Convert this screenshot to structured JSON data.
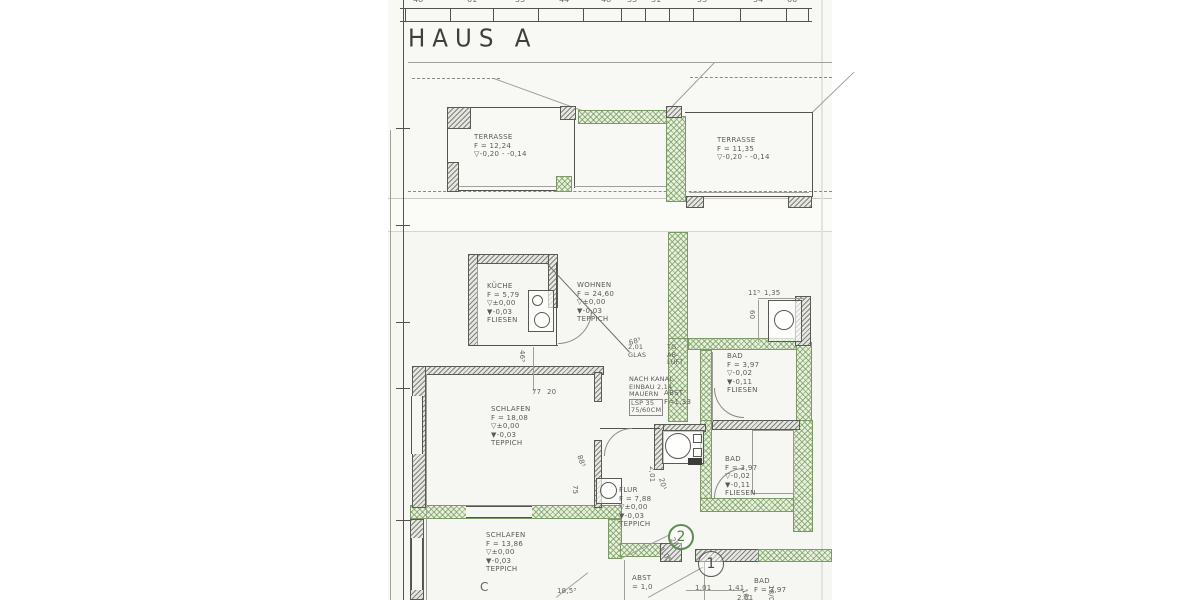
{
  "title": "HAUS A",
  "colors": {
    "paper": "#f6f6f2",
    "ink": "#55524d",
    "green_wall": "#689252",
    "marker_green": "#5d8f52"
  },
  "rooms": [
    {
      "name": "TERRASSE",
      "area": "F = 12,24",
      "level1": "▽-0,20 - -0,14"
    },
    {
      "name": "TERRASSE",
      "area": "F = 11,35",
      "level1": "▽-0,20 - -0,14"
    },
    {
      "name": "KÜCHE",
      "area": "F = 5,79",
      "level1": "▽±0,00",
      "level2": "▼-0,03",
      "floor": "FLIESEN"
    },
    {
      "name": "WOHNEN",
      "area": "F = 24,60",
      "level1": "▽±0,00",
      "level2": "▼-0,03",
      "floor": "TEPPICH"
    },
    {
      "name": "BAD",
      "area": "F = 3,97",
      "level1": "▽-0,02",
      "level2": "▼-0,11",
      "floor": "FLIESEN"
    },
    {
      "name": "SCHLAFEN",
      "area": "F = 18,08",
      "level1": "▽±0,00",
      "level2": "▼-0,03",
      "floor": "TEPPICH"
    },
    {
      "name": "ABST",
      "area": "F=1,33"
    },
    {
      "name": "BAD",
      "area": "F = 3,97",
      "level1": "▽-0,02",
      "level2": "▼-0,11",
      "floor": "FLIESEN"
    },
    {
      "name": "FLUR",
      "area": "F = 7,88",
      "level1": "▽±0,00",
      "level2": "▼-0,03",
      "floor": "TEPPICH"
    },
    {
      "name": "SCHLAFEN",
      "area": "F = 13,86",
      "level1": "▽±0,00",
      "level2": "▼-0,03",
      "floor": "TEPPICH"
    },
    {
      "name": "ABST",
      "area": "= 1,0"
    },
    {
      "name": "BAD",
      "area": "F = 3,97"
    }
  ],
  "notes": {
    "kanal": {
      "l1": "NACH KANAL",
      "l2": "EINBAU 2,14",
      "l3": "MAUERN",
      "l4": "LSP 35",
      "l5": "75/60CM"
    },
    "glas": {
      "l1": "2,01",
      "l2": "GLAS"
    },
    "abluft": {
      "l1": "TG",
      "l2": "AB-",
      "l3": "LUFT"
    }
  },
  "markers": {
    "m1": "1",
    "m2": "2"
  },
  "dimensions": [
    {
      "t": "11⁵",
      "x": 748,
      "y": 289
    },
    {
      "t": "1,35",
      "x": 764,
      "y": 289
    },
    {
      "t": "60",
      "x": 756,
      "y": 310,
      "r": 90
    },
    {
      "t": "46⁵",
      "x": 526,
      "y": 350,
      "r": 90
    },
    {
      "t": "77",
      "x": 532,
      "y": 388
    },
    {
      "t": "20",
      "x": 547,
      "y": 388
    },
    {
      "t": "68⁵",
      "x": 628,
      "y": 339,
      "r": -14
    },
    {
      "t": "88⁵",
      "x": 583,
      "y": 454,
      "r": 72
    },
    {
      "t": "75",
      "x": 579,
      "y": 485,
      "r": 90
    },
    {
      "t": "2,01",
      "x": 656,
      "y": 466,
      "r": 90
    },
    {
      "t": "20¹",
      "x": 665,
      "y": 477,
      "r": 76
    },
    {
      "t": "1,05",
      "x": 664,
      "y": 546,
      "r": 56
    },
    {
      "t": "20¹",
      "x": 675,
      "y": 536,
      "r": 56
    },
    {
      "t": "1,41",
      "x": 728,
      "y": 584
    },
    {
      "t": "1,01",
      "x": 695,
      "y": 584
    },
    {
      "t": "2,01",
      "x": 737,
      "y": 594
    },
    {
      "t": "18,5³",
      "x": 557,
      "y": 587
    },
    {
      "t": "18/0",
      "x": 775,
      "y": 585,
      "r": 90
    },
    {
      "t": "16/0",
      "x": 748,
      "y": 588,
      "r": 76
    },
    {
      "t": "C",
      "x": 480,
      "y": 580,
      "s": 12
    }
  ],
  "ruler_numbers": [
    {
      "t": "48¹",
      "x": 413
    },
    {
      "t": "61",
      "x": 467
    },
    {
      "t": "55",
      "x": 515
    },
    {
      "t": "44",
      "x": 559
    },
    {
      "t": "48",
      "x": 601
    },
    {
      "t": "35",
      "x": 627
    },
    {
      "t": "31",
      "x": 651
    },
    {
      "t": "53",
      "x": 697
    },
    {
      "t": "54",
      "x": 753
    },
    {
      "t": "60",
      "x": 787
    }
  ],
  "ruler_ticks": [
    405,
    450,
    493,
    538,
    583,
    621,
    645,
    669,
    693,
    740,
    786,
    808
  ]
}
